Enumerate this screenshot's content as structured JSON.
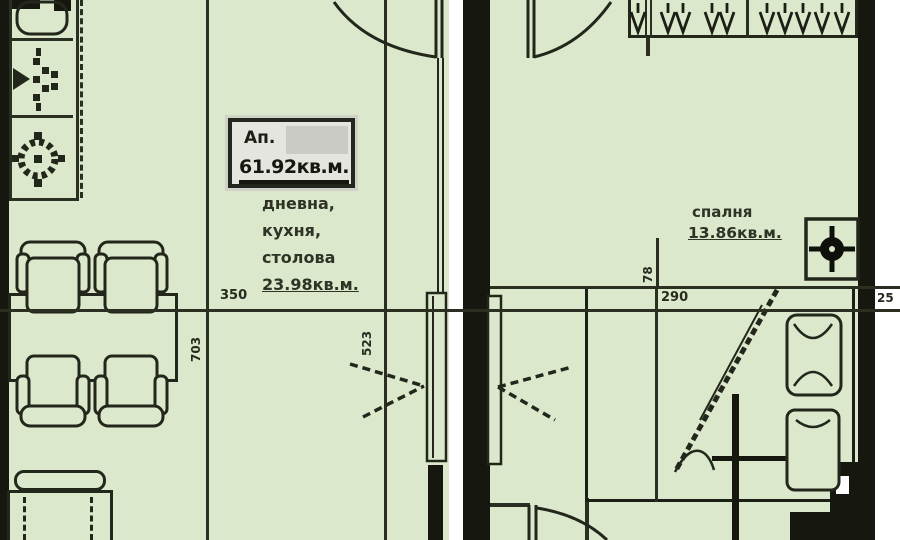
{
  "apartment_box": {
    "label": "Ап.",
    "area": "61.92кв.м."
  },
  "living_room": {
    "line1": "дневна,",
    "line2": "кухня,",
    "line3": "столова",
    "area": "23.98кв.м."
  },
  "bedroom": {
    "name": "спалня",
    "area": "13.86кв.м."
  },
  "dimensions": {
    "living_width": "350",
    "living_depth": "703",
    "hall_depth": "523",
    "bedroom_width": "290",
    "niche": "78",
    "wall_thickness": "25"
  },
  "icons": {
    "kitchen_sink": "sink-icon",
    "kitchen_faucet": "faucet-icon",
    "kitchen_burner": "burner-icon",
    "wardrobe_hangers": "hanger-icon",
    "bedroom_fixture": "ceiling-light-icon"
  },
  "colors": {
    "room_fill": "#dce8cc",
    "wall": "#16180f",
    "line": "#2b2f21",
    "white": "#ffffff",
    "label_box_fill": "#e5e5df",
    "redaction": "#cbcbc5",
    "text": "#272b1f"
  }
}
